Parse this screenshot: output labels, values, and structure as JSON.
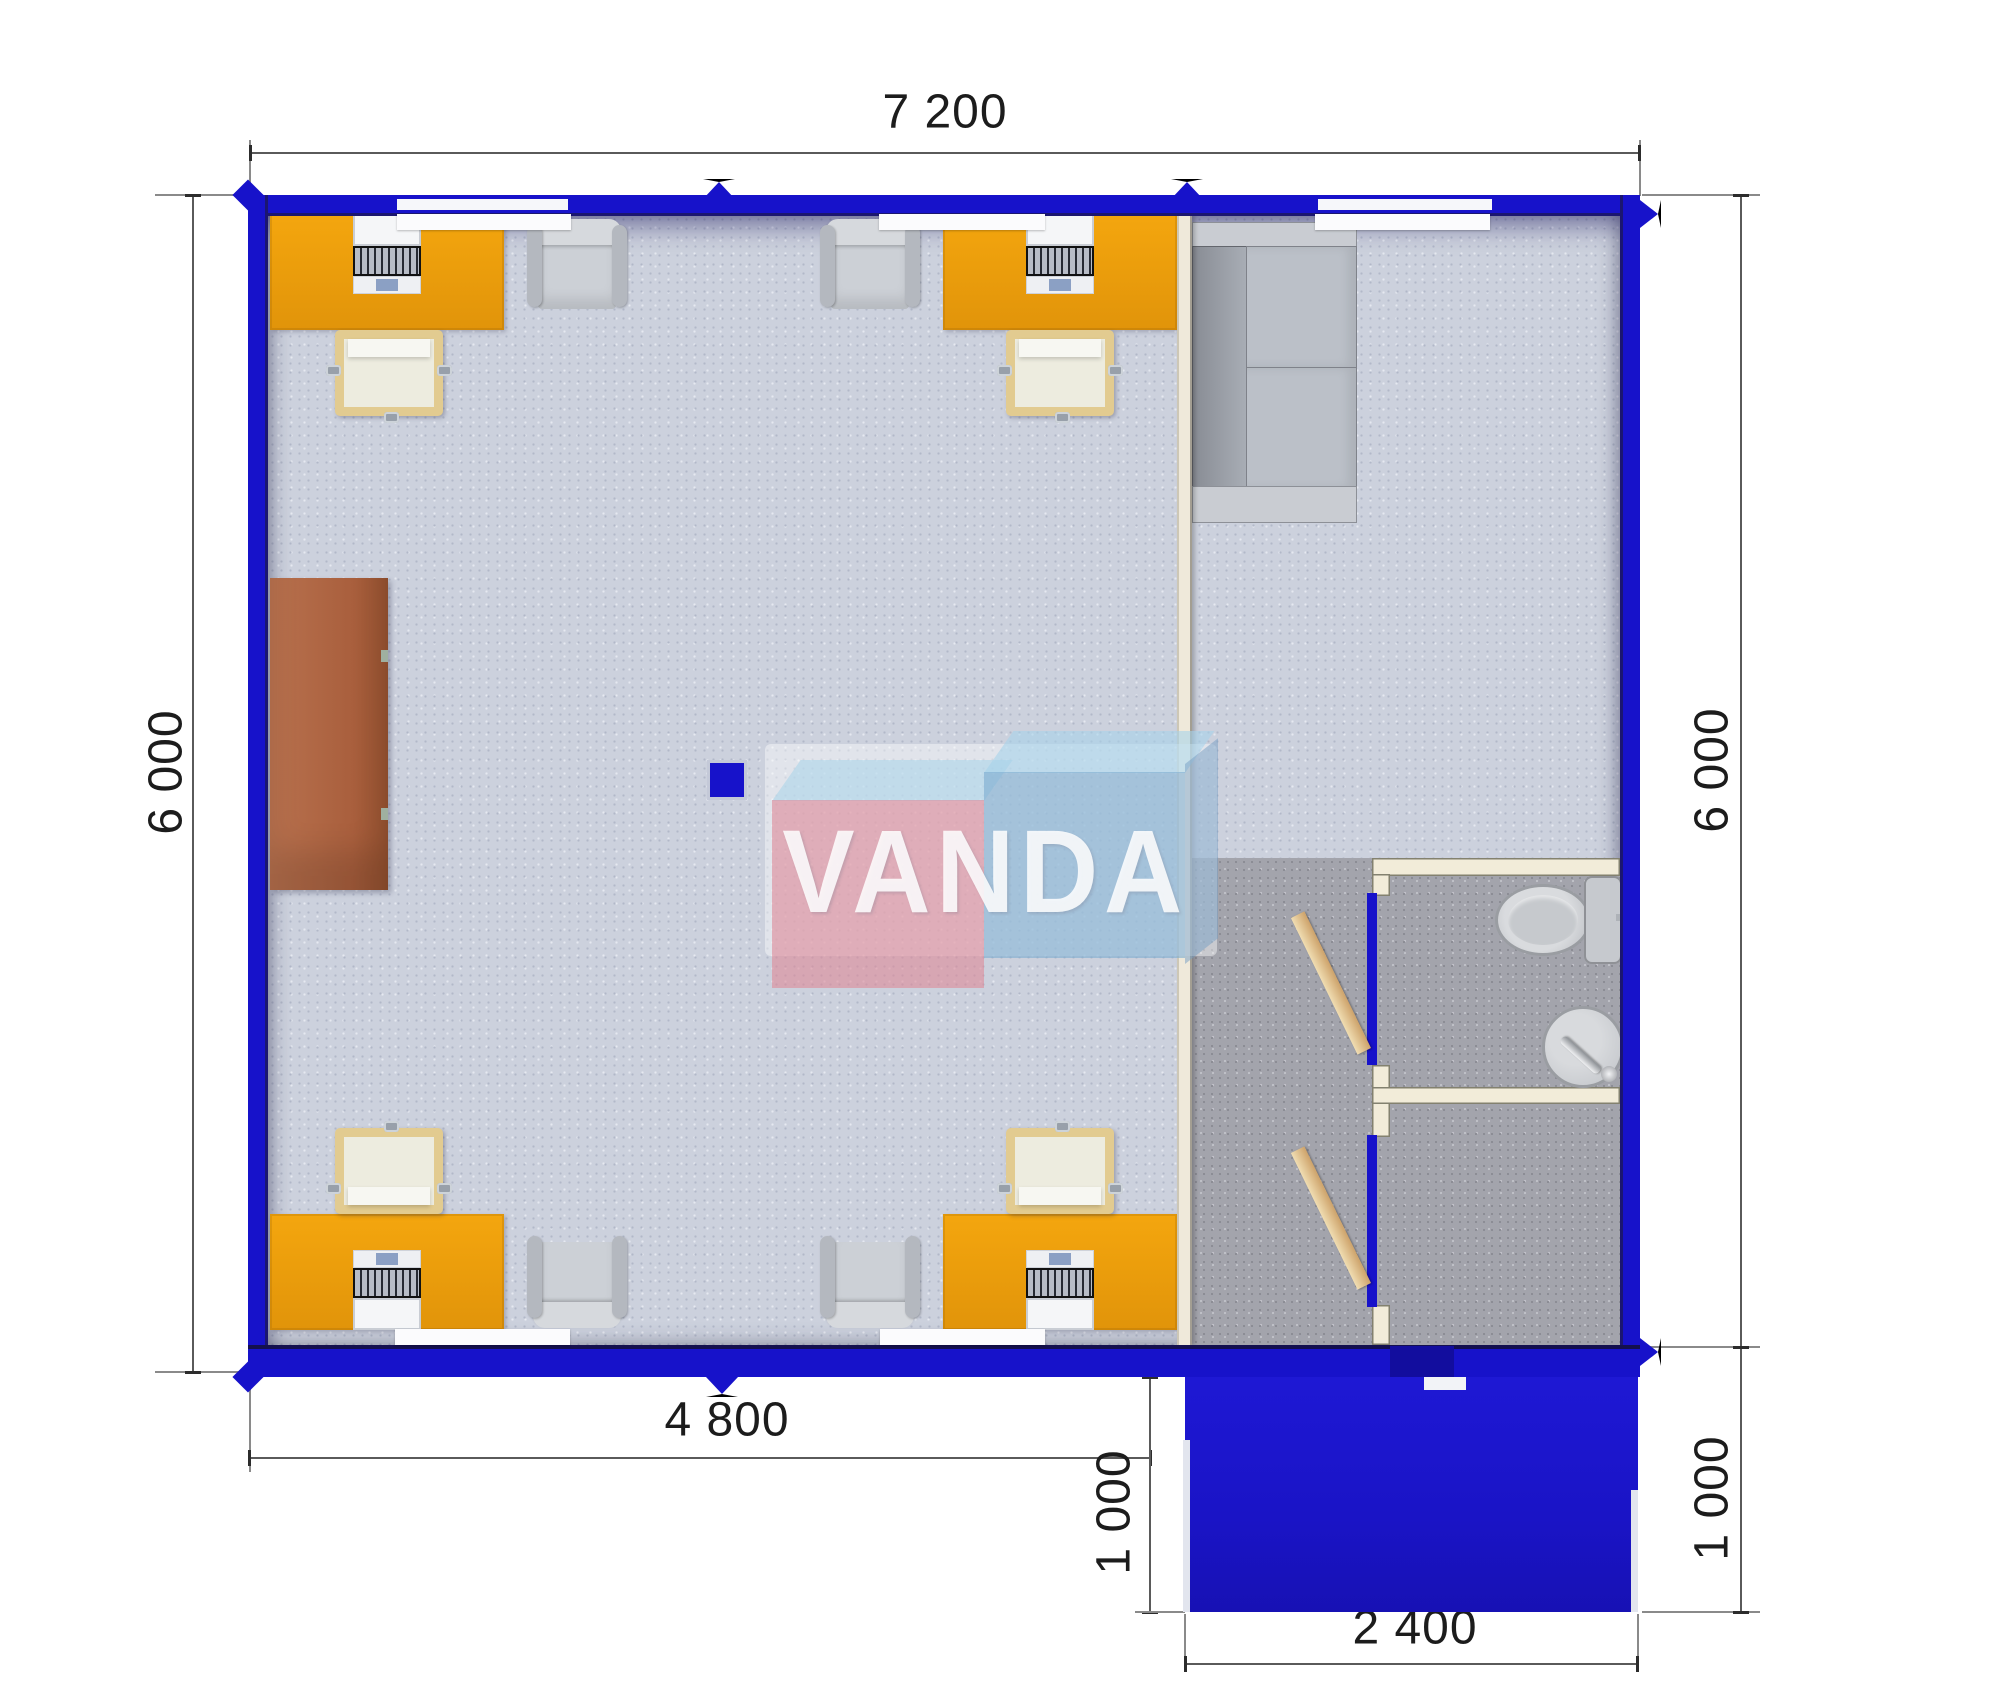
{
  "title": "VANDA modular cabin floor plan",
  "watermark": {
    "text": "VANDA"
  },
  "dimensions": {
    "top": "7 200",
    "left": "6 000",
    "right": "6 000",
    "bottom_left": "4 800",
    "porch_left": "1 000",
    "porch_right": "1 000",
    "porch_bottom": "2 400"
  },
  "plan_data": {
    "type": "floor-plan",
    "units": "mm",
    "building": {
      "width": 7200,
      "depth": 6000
    },
    "office_zone_width": 4800,
    "porch": {
      "width": 2400,
      "depth": 1000
    },
    "rooms": [
      "open office",
      "lounge / hallway",
      "WC with toilet and sink",
      "second sanitary room",
      "entrance canopy"
    ],
    "furniture": [
      "4 orange desks with laptops",
      "4 desk chairs",
      "4 visitor armchairs",
      "brown cabinet",
      "gray sofa",
      "toilet",
      "wash basin",
      "2 wooden doors",
      "structural column"
    ]
  },
  "colors": {
    "wall_blue": "#1712ca",
    "wall_navy": "#1b1670",
    "desk_orange": "#ea9b0b",
    "cabinet_brown": "#b06a48",
    "floor_light": "#ccd1dd",
    "floor_dark": "#a3a4ac",
    "bath_wall": "#f2ecd9",
    "door_wood": "#d8b483",
    "logo_pink": "#de8898",
    "logo_blue": "#7eacd0"
  }
}
